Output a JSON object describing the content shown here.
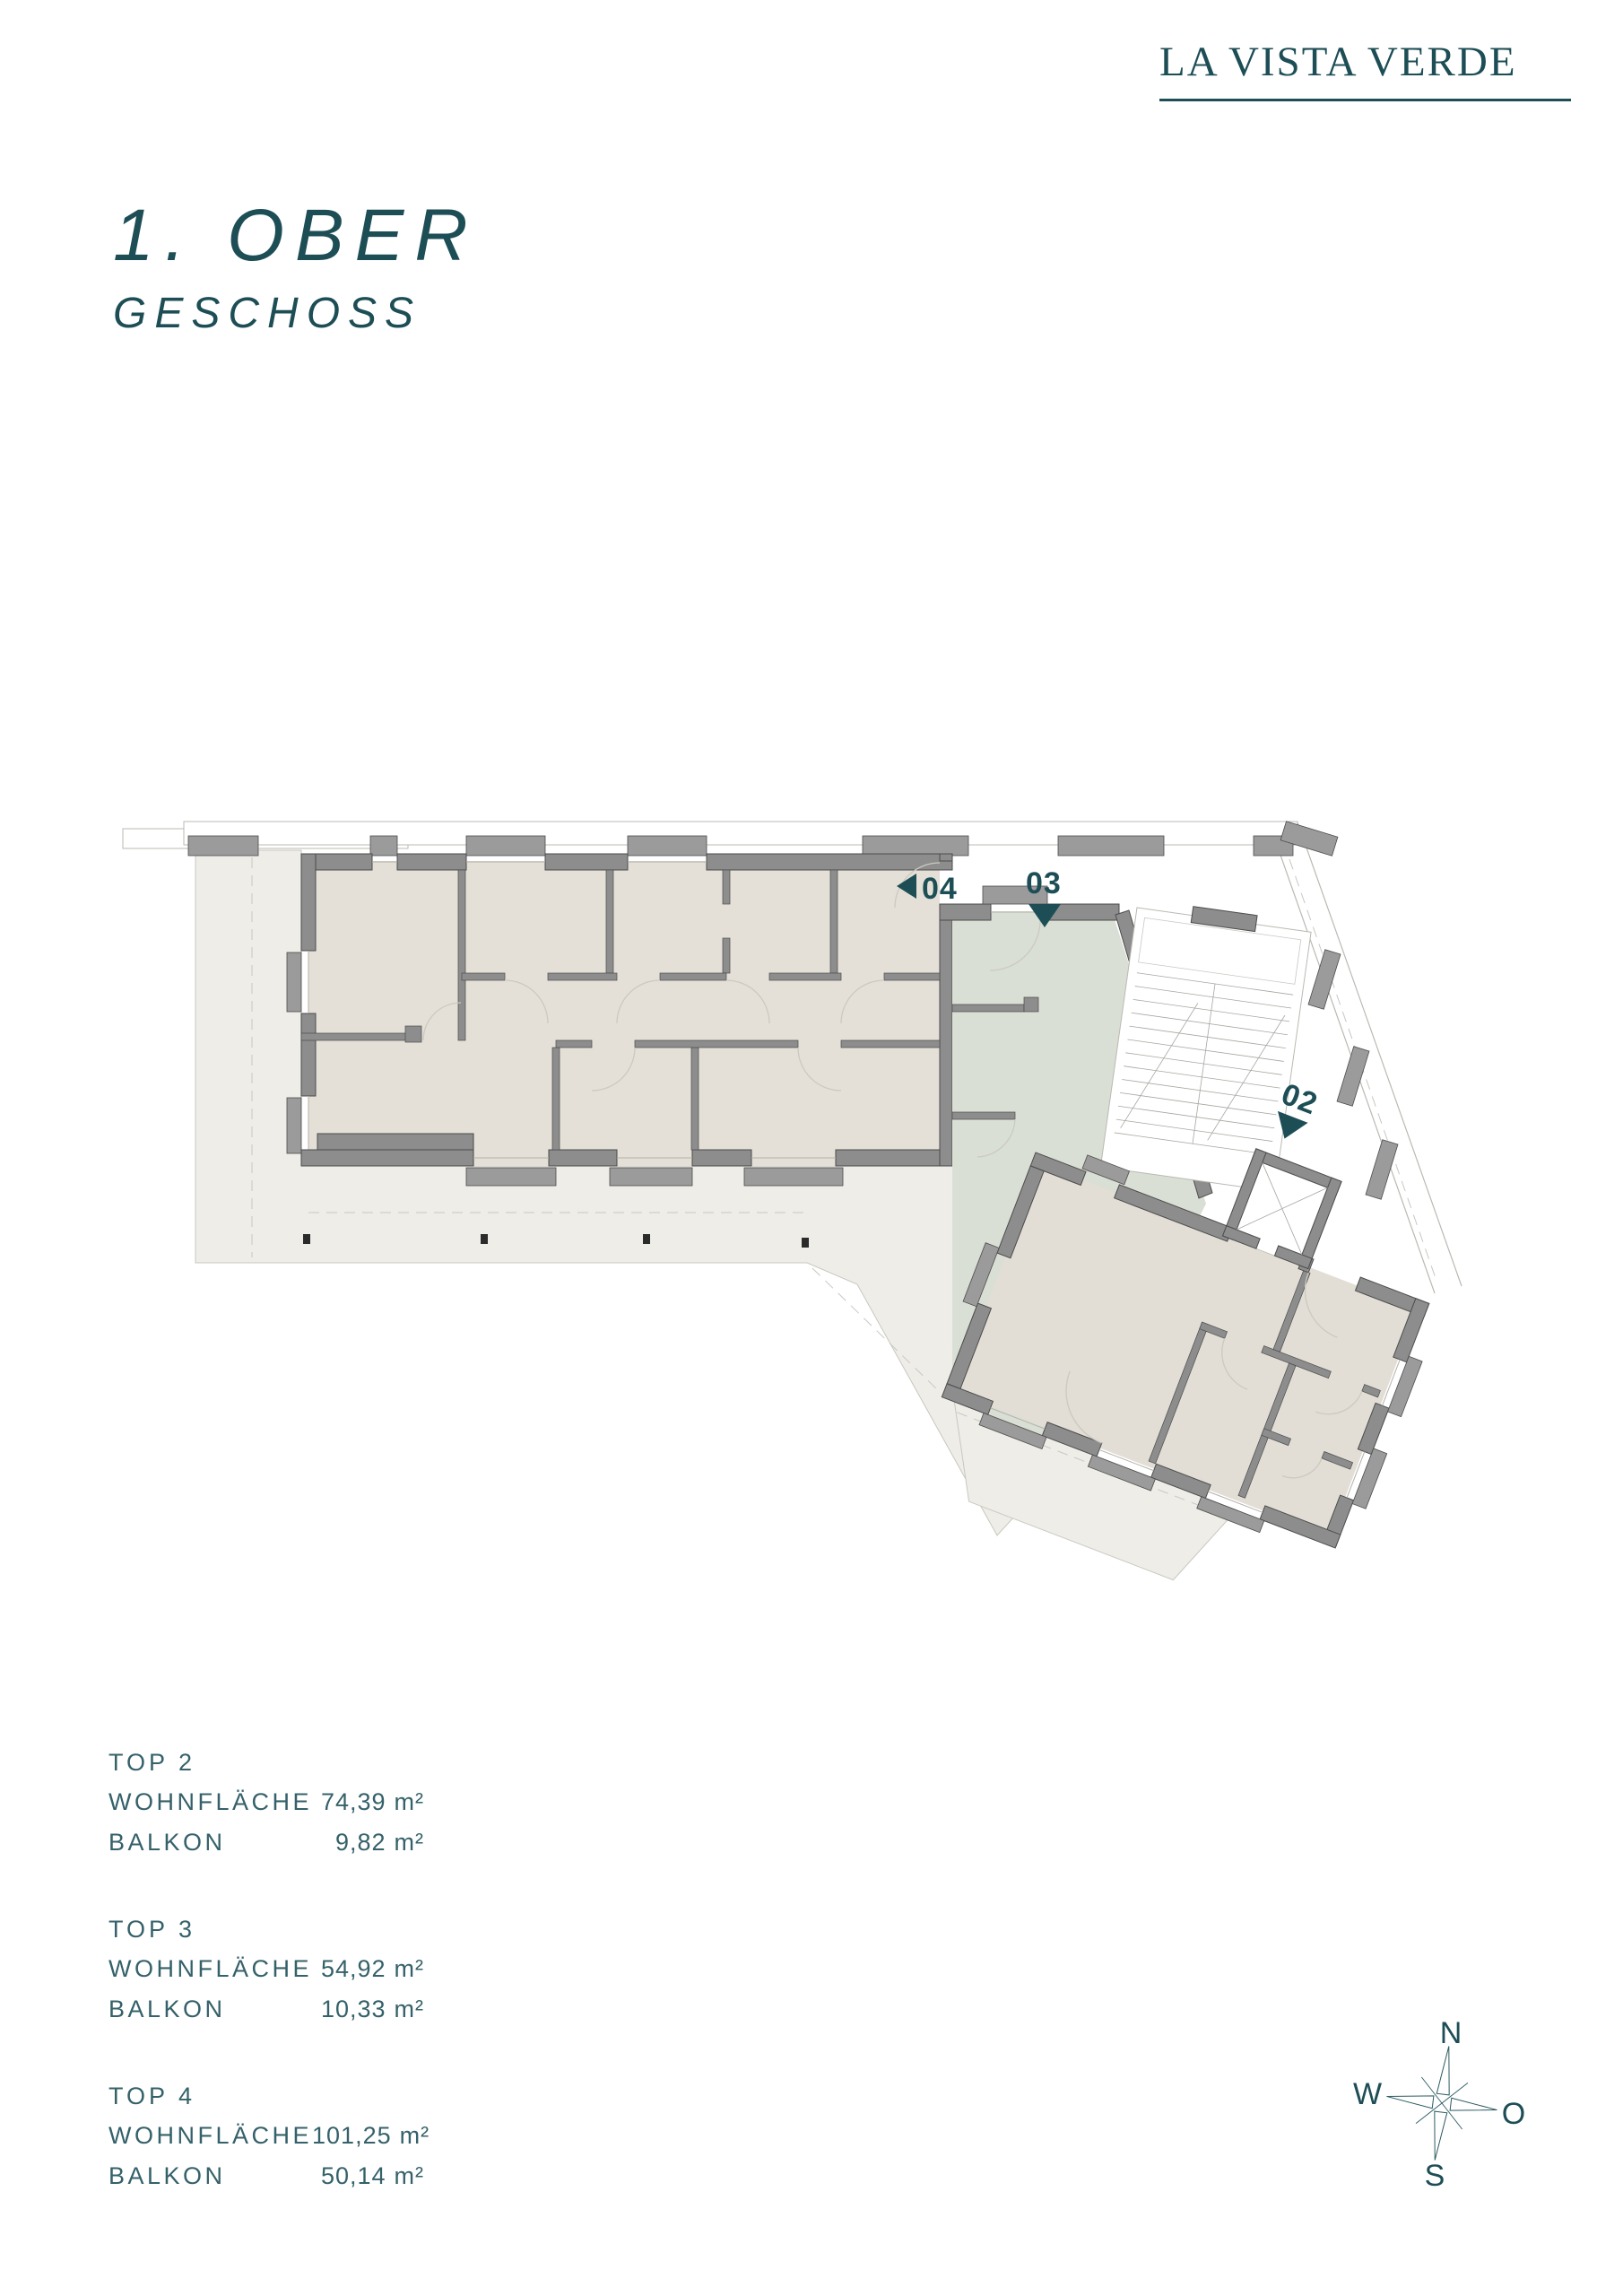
{
  "logo": {
    "text": "LA VISTA VERDE"
  },
  "title": {
    "line1": "1. OBER",
    "line2": "GESCHOSS"
  },
  "units": [
    {
      "name": "TOP 2",
      "rows": [
        {
          "label": "WOHNFLÄCHE",
          "value": "74,39",
          "unit": "m²"
        },
        {
          "label": "BALKON",
          "value": "9,82",
          "unit": "m²"
        }
      ]
    },
    {
      "name": "TOP 3",
      "rows": [
        {
          "label": "WOHNFLÄCHE",
          "value": "54,92",
          "unit": "m²"
        },
        {
          "label": "BALKON",
          "value": "10,33",
          "unit": "m²"
        }
      ]
    },
    {
      "name": "TOP 4",
      "rows": [
        {
          "label": "WOHNFLÄCHE",
          "value": "101,25",
          "unit": "m²"
        },
        {
          "label": "BALKON",
          "value": "50,14",
          "unit": "m²"
        }
      ]
    }
  ],
  "plan": {
    "markers": [
      {
        "id": "04",
        "direction": "left"
      },
      {
        "id": "03",
        "direction": "down"
      },
      {
        "id": "02",
        "direction": "down"
      }
    ]
  },
  "compass": {
    "n": "N",
    "e": "O",
    "s": "S",
    "w": "W"
  },
  "colors": {
    "accent": "#1d4e56",
    "legend_text": "#35616a",
    "room_beige": "#e4e0d7",
    "room_beige_right": "#e2ded5",
    "room_green": "#d9dfd4",
    "terrace": "#efede7",
    "wall_gray": "#8d8d8d",
    "wall_outline": "#4c4c4c"
  }
}
